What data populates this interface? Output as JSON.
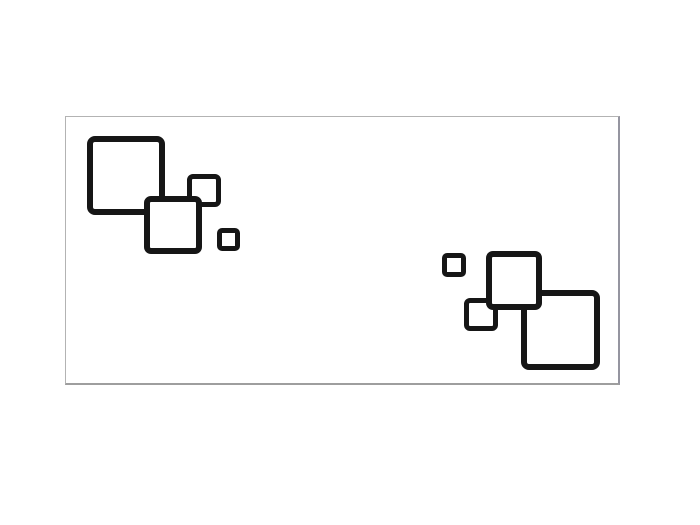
{
  "page": {
    "width": 700,
    "height": 525,
    "background": "#ffffff"
  },
  "canvas": {
    "left": 65,
    "top": 116,
    "width": 555,
    "height": 269,
    "background": "#ffffff",
    "border_top_color": "#b3b3b3",
    "border_left_color": "#b3b3b3",
    "border_right_color": "#9595a0",
    "border_bottom_color": "#9e9e9e",
    "border_width": 1,
    "border_right_width": 2,
    "border_bottom_width": 2
  },
  "square_style": {
    "stroke_color": "#161616",
    "fill_color": "#ffffff"
  },
  "squares": [
    {
      "name": "square-top-left-large",
      "cluster": "top-left",
      "left": 87,
      "top": 136,
      "width": 78,
      "height": 79,
      "stroke": 6,
      "radius": 8,
      "z": 1
    },
    {
      "name": "square-top-left-small",
      "cluster": "top-left",
      "left": 187,
      "top": 174,
      "width": 34,
      "height": 33,
      "stroke": 5,
      "radius": 6,
      "z": 2
    },
    {
      "name": "square-top-left-medium",
      "cluster": "top-left",
      "left": 144,
      "top": 196,
      "width": 58,
      "height": 58,
      "stroke": 6,
      "radius": 7,
      "z": 3
    },
    {
      "name": "square-top-left-tiny",
      "cluster": "top-left",
      "left": 217,
      "top": 228,
      "width": 23,
      "height": 23,
      "stroke": 5,
      "radius": 5,
      "z": 1
    },
    {
      "name": "square-bottom-right-tiny",
      "cluster": "bottom-right",
      "left": 442,
      "top": 253,
      "width": 24,
      "height": 24,
      "stroke": 5,
      "radius": 5,
      "z": 1
    },
    {
      "name": "square-bottom-right-medium",
      "cluster": "bottom-right",
      "left": 486,
      "top": 251,
      "width": 56,
      "height": 59,
      "stroke": 6,
      "radius": 7,
      "z": 3
    },
    {
      "name": "square-bottom-right-small",
      "cluster": "bottom-right",
      "left": 464,
      "top": 298,
      "width": 34,
      "height": 33,
      "stroke": 5,
      "radius": 6,
      "z": 2
    },
    {
      "name": "square-bottom-right-large",
      "cluster": "bottom-right",
      "left": 521,
      "top": 290,
      "width": 79,
      "height": 80,
      "stroke": 6,
      "radius": 8,
      "z": 1
    }
  ]
}
